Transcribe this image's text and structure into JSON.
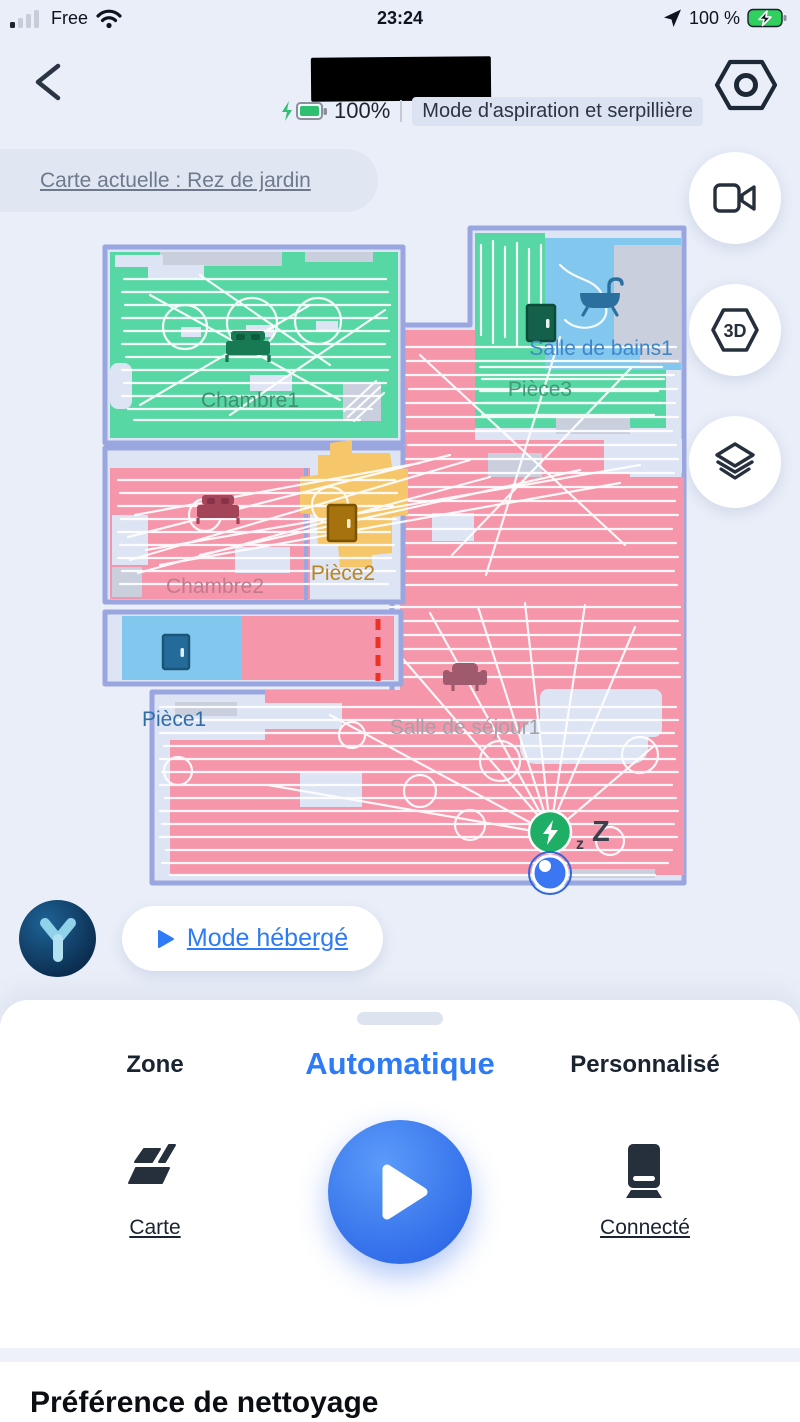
{
  "status_bar": {
    "carrier": "Free",
    "time": "23:24",
    "battery": "100 %"
  },
  "header": {
    "battery": "100%",
    "mode": "Mode d'aspiration et serpillière"
  },
  "map_bar": {
    "label": "Carte actuelle : Rez de jardin"
  },
  "floating": {
    "three_d": "3D"
  },
  "map": {
    "rooms": [
      {
        "name": "chambre1",
        "label": "Chambre1",
        "color": "#57d7a4",
        "icon": "bed"
      },
      {
        "name": "salle-de-bains1",
        "label": "Salle de bains1",
        "color": "#82c8ee",
        "icon": "bathtub"
      },
      {
        "name": "piece3",
        "label": "Pièce3",
        "color": "#57d7a4",
        "icon": "door"
      },
      {
        "name": "chambre2",
        "label": "Chambre2",
        "color": "#f596aa",
        "icon": "bed"
      },
      {
        "name": "piece2",
        "label": "Pièce2",
        "color": "#f6c76a",
        "icon": "door"
      },
      {
        "name": "piece1",
        "label": "Pièce1",
        "color": "#82c8ee",
        "icon": "door"
      },
      {
        "name": "salle-de-sejour1",
        "label": "Salle de séjour1",
        "color": "#f596aa",
        "icon": "couch"
      }
    ],
    "sleep_small": "z",
    "sleep_big": "Z",
    "virtual_wall_color": "#ee3124",
    "wall_color": "#9aa6df",
    "dock_color": "#1fae66",
    "robot_color": "#3b76f3"
  },
  "hosted": {
    "label": "Mode hébergé"
  },
  "sheet": {
    "tabs": [
      {
        "label": "Zone",
        "active": false
      },
      {
        "label": "Automatique",
        "active": true
      },
      {
        "label": "Personnalisé",
        "active": false
      }
    ],
    "map_action": "Carte",
    "dock_action": "Connecté"
  },
  "section": {
    "title": "Préférence de nettoyage"
  },
  "colors": {
    "accent_blue": "#2e7bf7",
    "page_bg": "#e9eef8",
    "floor": "#dde4f3"
  }
}
